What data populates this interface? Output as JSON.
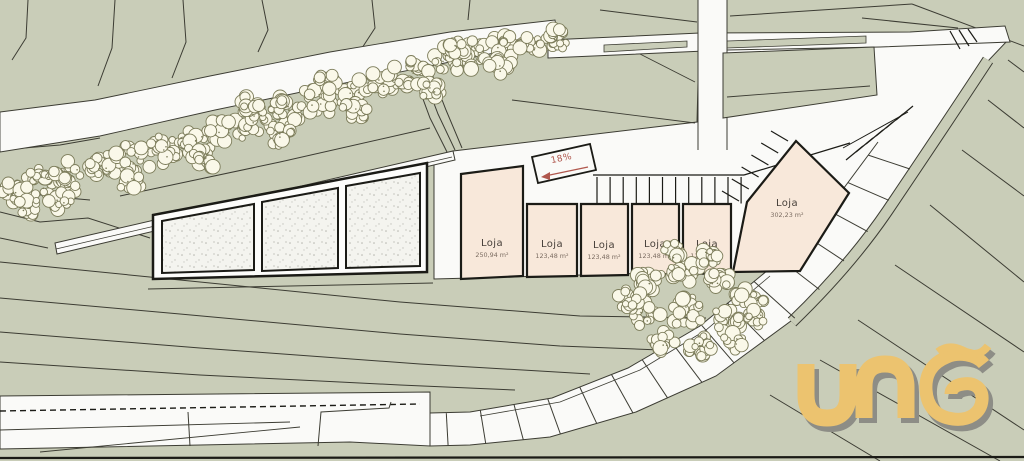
{
  "plan": {
    "ramp": {
      "label": "18%"
    },
    "units": [
      {
        "label": "Loja",
        "area": "250,94 m²"
      },
      {
        "label": "Loja",
        "area": "123,48 m²"
      },
      {
        "label": "Loja",
        "area": "123,48 m²"
      },
      {
        "label": "Loja",
        "area": "123,48 m²"
      },
      {
        "label": "Loja",
        "area": "123,48 m²"
      },
      {
        "label": "Loja",
        "area": "302,23 m²"
      }
    ],
    "logo_text": "una"
  },
  "colors": {
    "sage": "#c9cdb8",
    "paper": "#fafaf8",
    "beige": "#f8e8da",
    "tree_fill": "#faf8e9",
    "tree_stroke": "#7c7c5a",
    "ink": "#1b1b16",
    "contour": "#3c3c33",
    "stipple_bg": "#f4f4ef",
    "label": "#463f39",
    "label_sub": "#7b6c61",
    "ramp_red": "#b0574d",
    "logo_gold": "#ecc36f",
    "logo_shadow": "#8d8d86"
  }
}
